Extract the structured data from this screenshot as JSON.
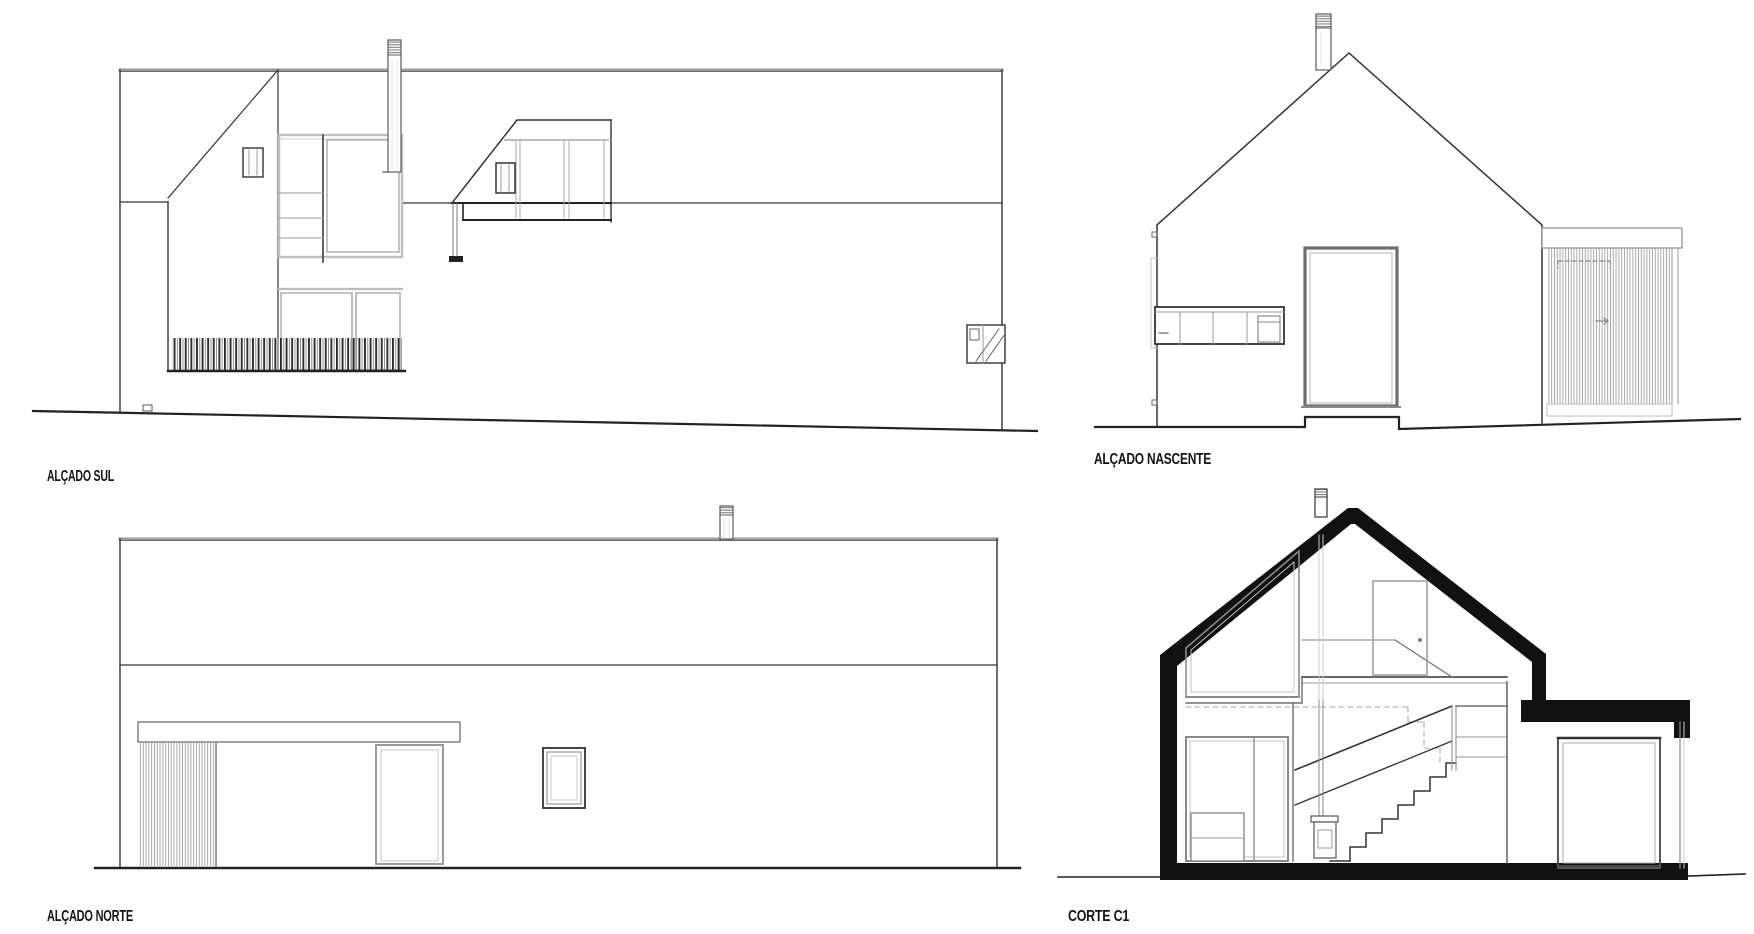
{
  "sheet": {
    "type": "architectural drawing sheet",
    "background_color": "#ffffff",
    "line_color": "#1f1f1f",
    "light_line_color": "#999999",
    "poche_color": "#111111"
  },
  "drawings": {
    "south_elevation": {
      "label": "ALÇADO SUL"
    },
    "east_elevation": {
      "label": "ALÇADO NASCENTE"
    },
    "north_elevation": {
      "label": "ALÇADO NORTE"
    },
    "section_c1": {
      "label": "CORTE C1"
    }
  }
}
